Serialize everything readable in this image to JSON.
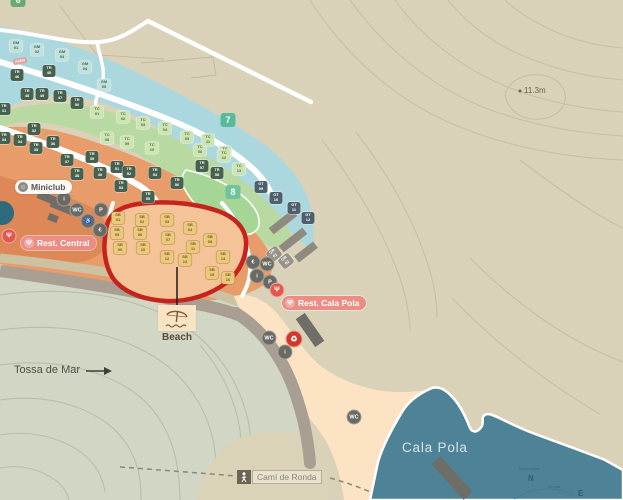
{
  "map": {
    "labels": {
      "tossa_de_mar": "Tossa de Mar",
      "cala_pola_bay": "Cala Pola",
      "beach": "Beach",
      "cami_de_ronda": "Camí de Ronda",
      "elevation_point": "11.3m",
      "area_tag": "ACER"
    },
    "compass": {
      "north": "N",
      "east": "E",
      "north_name": "Tramuntana",
      "east_name": "Gregal"
    },
    "pois": {
      "miniclub": "Miniclub",
      "rest_central": "Rest. Central",
      "rest_cala_pola": "Rest. Cala Pola"
    },
    "zone_badges": [
      {
        "label": "6",
        "x": 18,
        "y": 0,
        "color": "#68ab72"
      },
      {
        "label": "7",
        "x": 228,
        "y": 120,
        "color": "#55bb9a"
      },
      {
        "label": "8",
        "x": 233,
        "y": 192,
        "color": "#72c39c"
      }
    ],
    "pitch_markers": [
      {
        "label": "GM 01",
        "x": 16,
        "y": 46,
        "t": "gm"
      },
      {
        "label": "GM 02",
        "x": 37,
        "y": 50,
        "t": "gm"
      },
      {
        "label": "GM 03",
        "x": 62,
        "y": 55,
        "t": "gm"
      },
      {
        "label": "GM 04",
        "x": 85,
        "y": 67,
        "t": "gm"
      },
      {
        "label": "GM 05",
        "x": 104,
        "y": 85,
        "t": "gm"
      },
      {
        "label": "TR 45",
        "x": 49,
        "y": 71,
        "t": "tr"
      },
      {
        "label": "TR 46",
        "x": 17,
        "y": 75,
        "t": "tr"
      },
      {
        "label": "TR 47",
        "x": 60,
        "y": 96,
        "t": "tr"
      },
      {
        "label": "TR 48",
        "x": 27,
        "y": 94,
        "t": "tr"
      },
      {
        "label": "TR 49",
        "x": 42,
        "y": 94,
        "t": "tr"
      },
      {
        "label": "TR 50",
        "x": 77,
        "y": 103,
        "t": "tr"
      },
      {
        "label": "TC 01",
        "x": 97,
        "y": 112,
        "t": "tc"
      },
      {
        "label": "TC 02",
        "x": 123,
        "y": 117,
        "t": "tc"
      },
      {
        "label": "TC 03",
        "x": 143,
        "y": 123,
        "t": "tc"
      },
      {
        "label": "TC 04",
        "x": 165,
        "y": 128,
        "t": "tc"
      },
      {
        "label": "TC 05",
        "x": 187,
        "y": 137,
        "t": "tc"
      },
      {
        "label": "TC 06",
        "x": 200,
        "y": 150,
        "t": "tc"
      },
      {
        "label": "TC 07",
        "x": 225,
        "y": 152,
        "t": "tc"
      },
      {
        "label": "TC 08",
        "x": 107,
        "y": 138,
        "t": "tc"
      },
      {
        "label": "TC 09",
        "x": 127,
        "y": 142,
        "t": "tc"
      },
      {
        "label": "TC 10",
        "x": 152,
        "y": 148,
        "t": "tc"
      },
      {
        "label": "TC 11",
        "x": 208,
        "y": 140,
        "t": "tc"
      },
      {
        "label": "TC 12",
        "x": 224,
        "y": 156,
        "t": "tc"
      },
      {
        "label": "TC 13",
        "x": 239,
        "y": 169,
        "t": "tc"
      },
      {
        "label": "TR 31",
        "x": 4,
        "y": 109,
        "t": "tr"
      },
      {
        "label": "TR 32",
        "x": 34,
        "y": 129,
        "t": "tr"
      },
      {
        "label": "TR 33",
        "x": 4,
        "y": 138,
        "t": "tr"
      },
      {
        "label": "TR 34",
        "x": 20,
        "y": 140,
        "t": "tr"
      },
      {
        "label": "TR 35",
        "x": 36,
        "y": 148,
        "t": "tr"
      },
      {
        "label": "TR 36",
        "x": 53,
        "y": 142,
        "t": "tr"
      },
      {
        "label": "TR 37",
        "x": 67,
        "y": 160,
        "t": "tr"
      },
      {
        "label": "TR 38",
        "x": 77,
        "y": 174,
        "t": "tr"
      },
      {
        "label": "TR 39",
        "x": 92,
        "y": 157,
        "t": "tr"
      },
      {
        "label": "TR 40",
        "x": 100,
        "y": 173,
        "t": "tr"
      },
      {
        "label": "TR 51",
        "x": 117,
        "y": 167,
        "t": "tr"
      },
      {
        "label": "TR 52",
        "x": 129,
        "y": 172,
        "t": "tr"
      },
      {
        "label": "TR 53",
        "x": 121,
        "y": 186,
        "t": "tr"
      },
      {
        "label": "TR 54",
        "x": 155,
        "y": 173,
        "t": "tr"
      },
      {
        "label": "TR 55",
        "x": 148,
        "y": 197,
        "t": "tr"
      },
      {
        "label": "TR 56",
        "x": 177,
        "y": 183,
        "t": "tr"
      },
      {
        "label": "TR 57",
        "x": 202,
        "y": 166,
        "t": "tr"
      },
      {
        "label": "TR 58",
        "x": 217,
        "y": 173,
        "t": "tr"
      },
      {
        "label": "GT 09",
        "x": 261,
        "y": 187,
        "t": "gt"
      },
      {
        "label": "GT 10",
        "x": 276,
        "y": 198,
        "t": "gt"
      },
      {
        "label": "GT 11",
        "x": 294,
        "y": 208,
        "t": "gt"
      },
      {
        "label": "GT 12",
        "x": 308,
        "y": 218,
        "t": "gt"
      },
      {
        "label": "SB 01",
        "x": 118,
        "y": 218,
        "t": "sb"
      },
      {
        "label": "SB 02",
        "x": 142,
        "y": 220,
        "t": "sb"
      },
      {
        "label": "SB 03",
        "x": 167,
        "y": 220,
        "t": "sb"
      },
      {
        "label": "SB 04",
        "x": 190,
        "y": 228,
        "t": "sb"
      },
      {
        "label": "SB 05",
        "x": 117,
        "y": 233,
        "t": "sb"
      },
      {
        "label": "SB 06",
        "x": 140,
        "y": 233,
        "t": "sb"
      },
      {
        "label": "SB 07",
        "x": 168,
        "y": 238,
        "t": "sb"
      },
      {
        "label": "SB 08",
        "x": 210,
        "y": 240,
        "t": "sb"
      },
      {
        "label": "SB 09",
        "x": 120,
        "y": 248,
        "t": "sb"
      },
      {
        "label": "SB 10",
        "x": 143,
        "y": 248,
        "t": "sb"
      },
      {
        "label": "SB 11",
        "x": 193,
        "y": 247,
        "t": "sb"
      },
      {
        "label": "SB 12",
        "x": 167,
        "y": 257,
        "t": "sb"
      },
      {
        "label": "SB 13",
        "x": 185,
        "y": 260,
        "t": "sb"
      },
      {
        "label": "SB 14",
        "x": 223,
        "y": 257,
        "t": "sb"
      },
      {
        "label": "SB 15",
        "x": 212,
        "y": 273,
        "t": "sb"
      },
      {
        "label": "SB 16",
        "x": 228,
        "y": 278,
        "t": "sb"
      },
      {
        "label": "GR 01",
        "x": 274,
        "y": 254,
        "t": "gr",
        "rot": -38
      },
      {
        "label": "GR 02",
        "x": 286,
        "y": 261,
        "t": "gr",
        "rot": -38
      }
    ],
    "facilities": [
      {
        "name": "info-icon",
        "glyph": "i",
        "x": 64,
        "y": 199,
        "k": "gray"
      },
      {
        "name": "wc-icon",
        "glyph": "WC",
        "x": 77,
        "y": 210,
        "k": "gray"
      },
      {
        "name": "parking-icon",
        "glyph": "P",
        "x": 101,
        "y": 210,
        "k": "gray"
      },
      {
        "name": "accessible-icon",
        "glyph": "♿",
        "x": 88,
        "y": 221,
        "k": "gray"
      },
      {
        "name": "shop-icon",
        "glyph": "€",
        "x": 100,
        "y": 230,
        "k": "gray"
      },
      {
        "name": "atm-icon",
        "glyph": "€",
        "x": 253,
        "y": 262,
        "k": "gray"
      },
      {
        "name": "wc-icon",
        "glyph": "WC",
        "x": 267,
        "y": 264,
        "k": "gray"
      },
      {
        "name": "info-icon",
        "glyph": "i",
        "x": 257,
        "y": 276,
        "k": "gray"
      },
      {
        "name": "parking-icon",
        "glyph": "P",
        "x": 270,
        "y": 282,
        "k": "gray"
      },
      {
        "name": "restaurant-badge-icon",
        "glyph": "Ψ",
        "x": 9,
        "y": 236,
        "k": "rest"
      },
      {
        "name": "restaurant-badge-icon",
        "glyph": "Ψ",
        "x": 277,
        "y": 290,
        "k": "rest"
      },
      {
        "name": "wc-icon",
        "glyph": "WC",
        "x": 269,
        "y": 338,
        "k": "gray"
      },
      {
        "name": "recycling-icon",
        "glyph": "♻",
        "x": 294,
        "y": 339,
        "k": "red"
      },
      {
        "name": "info-icon",
        "glyph": "i",
        "x": 285,
        "y": 352,
        "k": "gray"
      },
      {
        "name": "wc-icon",
        "glyph": "WC",
        "x": 354,
        "y": 417,
        "k": "gray"
      }
    ],
    "colors": {
      "water": "#4e8296",
      "sand": "#fbe3c3",
      "stream": "#abd7de",
      "camp_orange": "#e79c6a",
      "camp_green": "#b9d9a2",
      "highlight_red": "#c4241c",
      "hill_sage": "#d2d6c4",
      "hill_tan": "#d9d2b8"
    }
  }
}
